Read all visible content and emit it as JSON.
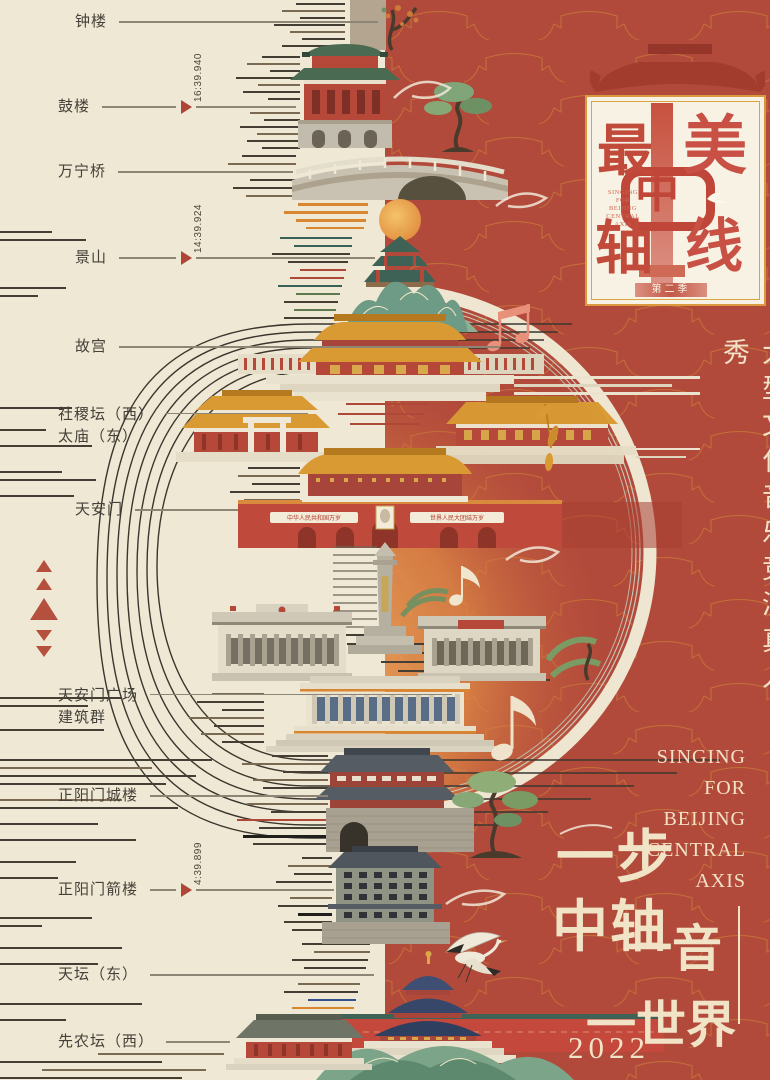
{
  "left_panel": {
    "landmarks": [
      {
        "name": "钟楼"
      },
      {
        "name": "鼓楼",
        "timestamp": "16:39.940"
      },
      {
        "name": "万宁桥"
      },
      {
        "name": "景山",
        "timestamp": "14:39.924"
      },
      {
        "name": "故宫"
      },
      {
        "name": "社稷坛（西）",
        "name2": "太庙（东）"
      },
      {
        "name": "天安门"
      },
      {
        "name": "天安门广场",
        "name2": "建筑群"
      },
      {
        "name": "正阳门城楼"
      },
      {
        "name": "正阳门箭楼",
        "timestamp": "4:39.899"
      },
      {
        "name": "天坛（东）"
      },
      {
        "name": "先农坛（西）"
      }
    ]
  },
  "badge": {
    "title_chars": [
      "最",
      "美",
      "中",
      "轴",
      "线"
    ],
    "subtitle_lines": [
      "SINGING",
      "FOR",
      "BEIJING",
      "CENTRAL",
      "AXIS"
    ],
    "season": "第二季"
  },
  "tiananmen": {
    "slogan_left": "中华人民共和国万岁",
    "slogan_right": "世界人民大团结万岁"
  },
  "right_panel": {
    "show_type_vertical": "大型文化音乐竞演真人秀",
    "english_lines": [
      "SINGING",
      "FOR",
      "BEIJING",
      "CENTRAL",
      "AXIS"
    ],
    "tagline": {
      "part1": "一步",
      "part2": "中轴",
      "part3": "一音",
      "part4": "一世界"
    },
    "year": "2022"
  },
  "colors": {
    "cream_background": "#efe8d4",
    "red_background": "#b24a3b",
    "pattern_orange": "#c97c36",
    "accent_gold": "#d99a33",
    "marker_red": "#ae4637",
    "text_dark": "#45413a",
    "text_cream": "#f3e2c6"
  }
}
